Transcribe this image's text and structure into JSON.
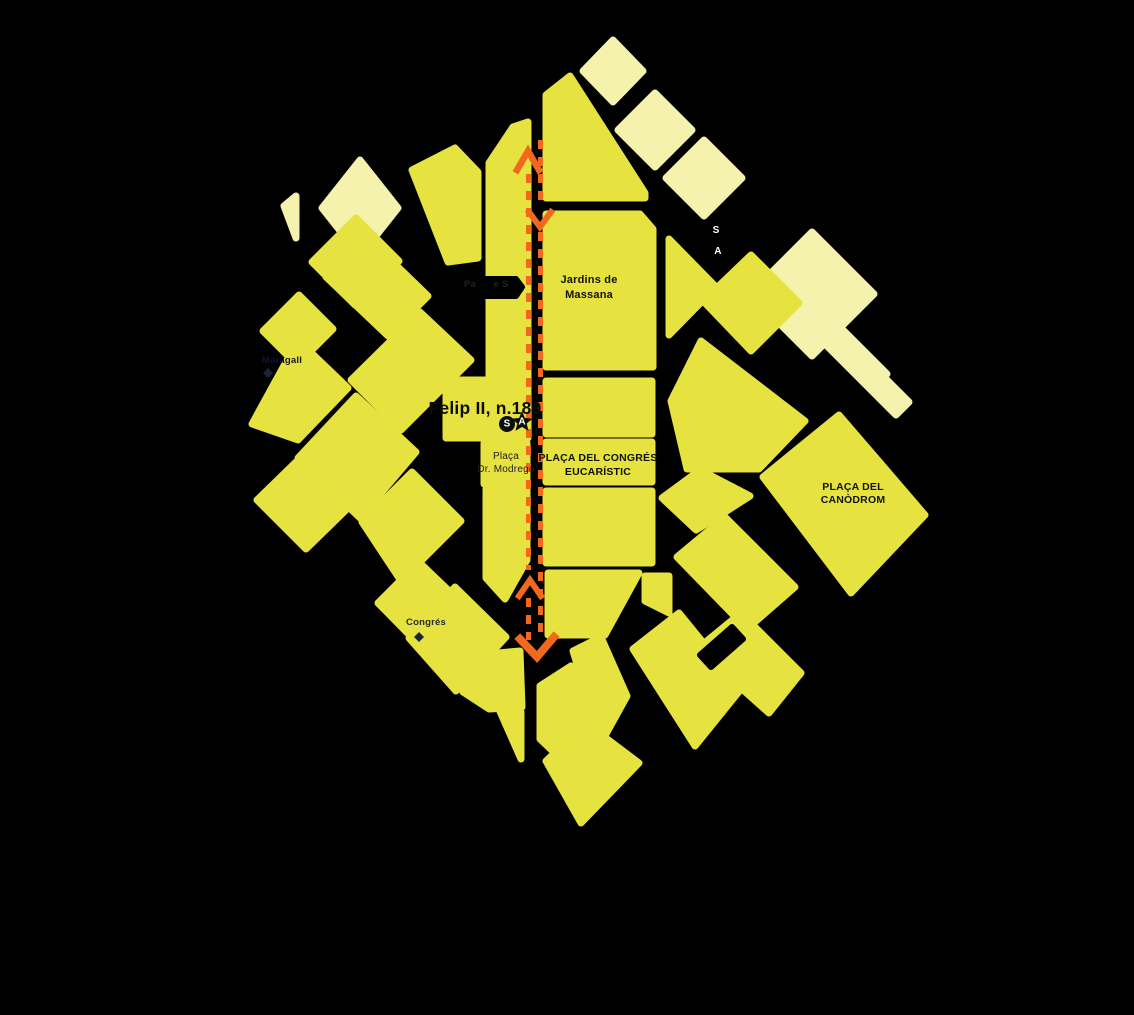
{
  "map": {
    "background_color": "#000000",
    "block_color": "#e6e23f",
    "pale_block_color": "#f5f2ae",
    "road_color": "#000000",
    "route_color": "#f2691e",
    "blocks": [
      {
        "name": "pale-diamond-1",
        "tone": "pale",
        "points": "613,40 643,71 613,102 583,71"
      },
      {
        "name": "pale-diamond-2",
        "tone": "pale",
        "points": "655,93 692,130 655,167 618,130"
      },
      {
        "name": "pale-diamond-3",
        "tone": "pale",
        "points": "704,140 742,178 704,216 666,178"
      },
      {
        "name": "pale-diamond-4",
        "tone": "pale",
        "points": "812,232 874,294 812,356 750,294"
      },
      {
        "name": "pale-stripe-1",
        "tone": "pale",
        "points": "799,312 812,299 887,374 874,387"
      },
      {
        "name": "pale-stripe-2",
        "tone": "pale",
        "points": "821,340 834,327 909,402 896,415"
      },
      {
        "name": "pale-diamond-5",
        "tone": "pale",
        "points": "360,160 398,208 360,256 322,208"
      },
      {
        "name": "pale-sliver",
        "tone": "pale",
        "points": "284,206 296,196 296,238"
      },
      {
        "name": "felip-strip",
        "tone": "main",
        "points": "489,163 513,127 528,122 528,438 446,438 446,380 489,380"
      },
      {
        "name": "top-block",
        "tone": "main",
        "points": "546,95 570,76 645,193 645,198 546,198"
      },
      {
        "name": "jardins-massana-block",
        "tone": "main",
        "points": "546,214 640,214 653,229 653,367 546,367"
      },
      {
        "name": "congres-upper-block",
        "tone": "main",
        "points": "546,381 652,381 652,434 546,434"
      },
      {
        "name": "congres-label-block",
        "tone": "main",
        "points": "546,442 652,442 652,482 546,482"
      },
      {
        "name": "congres-lower-block",
        "tone": "main",
        "points": "546,491 652,491 652,563 546,563"
      },
      {
        "name": "block-se-1",
        "tone": "main",
        "points": "548,573 639,573 605,635 548,635"
      },
      {
        "name": "block-se-2",
        "tone": "main",
        "points": "645,576 669,576 669,613 645,601"
      },
      {
        "name": "modrego-south-strip",
        "tone": "main",
        "points": "486,489 527,489 527,560 505,599 486,578"
      },
      {
        "name": "placa-modrego-block",
        "tone": "main",
        "points": "484,443 527,443 527,484 484,484"
      },
      {
        "name": "fan-strip-1",
        "tone": "main",
        "points": "412,170 455,148 478,172 478,258 448,262"
      },
      {
        "name": "fan-diamond-1",
        "tone": "main",
        "points": "312,262 356,218 399,261 355,305"
      },
      {
        "name": "fan-parallelogram-1",
        "tone": "main",
        "points": "366,236 428,296 388,336 326,277"
      },
      {
        "name": "fan-diamond-2",
        "tone": "main",
        "points": "263,331 299,295 333,329 297,365"
      },
      {
        "name": "west-wedge",
        "tone": "main",
        "points": "252,424 298,340 348,388 298,440"
      },
      {
        "name": "fan-big-diamond",
        "tone": "main",
        "points": "356,396 416,452 360,518 298,458"
      },
      {
        "name": "fan-parallelogram-2",
        "tone": "main",
        "points": "420,312 471,360 401,430 351,380"
      },
      {
        "name": "fan-diamond-3",
        "tone": "main",
        "points": "296,462 346,510 306,549 257,500"
      },
      {
        "name": "fan-diamond-4",
        "tone": "main",
        "points": "362,522 412,472 461,521 401,581"
      },
      {
        "name": "fan-diamond-5",
        "tone": "main",
        "points": "419,562 470,611 429,655 378,603"
      },
      {
        "name": "congres-station-diamond",
        "tone": "main",
        "points": "455,587 506,637 456,691 409,638"
      },
      {
        "name": "bottom-left-block",
        "tone": "main",
        "points": "463,656 520,651 522,707 489,709 463,692"
      },
      {
        "name": "bottom-left-triangle",
        "tone": "main",
        "points": "498,707 521,712 521,759"
      },
      {
        "name": "bottom-block-1",
        "tone": "main",
        "points": "540,686 571,666 593,689 593,741 563,761 540,739"
      },
      {
        "name": "bottom-block-2",
        "tone": "main",
        "points": "573,651 601,637 627,696 601,743"
      },
      {
        "name": "bottom-tip-diamond",
        "tone": "main",
        "points": "546,761 586,723 639,763 581,823"
      },
      {
        "name": "bottom-band-1",
        "tone": "main",
        "points": "633,649 679,613 741,689 695,746"
      },
      {
        "name": "bottom-band-2",
        "tone": "main",
        "points": "697,649 741,613 801,673 769,713"
      },
      {
        "name": "lower-right-diamond",
        "tone": "main",
        "points": "677,557 725,517 795,587 747,629"
      },
      {
        "name": "east-triangle",
        "tone": "main",
        "points": "669,239 716,287 669,335"
      },
      {
        "name": "east-diamond-1",
        "tone": "main",
        "points": "703,301 751,255 799,303 751,351"
      },
      {
        "name": "east-band",
        "tone": "main",
        "points": "671,401 701,341 805,421 759,469 687,469"
      },
      {
        "name": "canodrom-diamond",
        "tone": "main",
        "points": "839,415 925,515 851,593 763,477"
      },
      {
        "name": "east-small-block",
        "tone": "main",
        "points": "662,498 700,470 750,496 722,514 696,530"
      }
    ],
    "road_overlays": [
      {
        "name": "dead-end-street-stub",
        "points": "440,279 516,279 522,287 516,296 440,296"
      },
      {
        "name": "diagonal-street-notch",
        "points": "700,655 732,627 743,639 711,667"
      }
    ],
    "route": {
      "dash": "9 8",
      "line_width": 5,
      "lines": [
        {
          "name": "route-line-north",
          "x": 528.5,
          "segments": [
            [
              174,
              570
            ],
            [
              598,
              640
            ]
          ]
        },
        {
          "name": "route-line-south",
          "x": 540.5,
          "segments": [
            [
              140,
              206
            ],
            [
              232,
              634
            ]
          ]
        }
      ],
      "chevrons": [
        {
          "name": "route-arrow-up-top",
          "points": "517,170 528,151 539,170",
          "width": 6.5
        },
        {
          "name": "route-arrow-down-mid",
          "points": "529,212 540,227 551,212",
          "width": 6
        },
        {
          "name": "route-arrow-up-mid",
          "points": "519,596 530,580 541,596",
          "width": 6
        },
        {
          "name": "route-arrow-down-bottom",
          "points": "520,639 537,657 554,637",
          "width": 8
        }
      ]
    },
    "labels": [
      {
        "name": "label-felip-ii",
        "lines": [
          "Felip II, n.189"
        ],
        "x": 485,
        "y": 414,
        "size": 17.5,
        "weight": 700,
        "fill": "#0d0d0d",
        "lh": 18
      },
      {
        "name": "label-jardins-massana",
        "lines": [
          "Jardins de",
          "Massana"
        ],
        "x": 589,
        "y": 283,
        "size": 11,
        "weight": 700,
        "fill": "#111111",
        "lh": 15
      },
      {
        "name": "label-placa-congres",
        "lines": [
          "PLAÇA DEL CONGRÉS",
          "EUCARÍSTIC"
        ],
        "x": 598,
        "y": 461,
        "size": 10.5,
        "weight": 700,
        "fill": "#111111",
        "lh": 14
      },
      {
        "name": "label-placa-canodrom",
        "lines": [
          "PLAÇA DEL",
          "CANÒDROM"
        ],
        "x": 853,
        "y": 490,
        "size": 10.5,
        "weight": 700,
        "fill": "#111111",
        "lh": 13
      },
      {
        "name": "label-placa-modrego",
        "lines": [
          "Plaça",
          "Dr. Modrego"
        ],
        "x": 506,
        "y": 459,
        "size": 10,
        "weight": 400,
        "fill": "#222222",
        "lh": 13
      },
      {
        "name": "label-maragall",
        "lines": [
          "Maragall"
        ],
        "x": 282,
        "y": 363,
        "size": 9.5,
        "weight": 700,
        "fill": "#10152b",
        "lh": 10
      },
      {
        "name": "label-congres-station",
        "lines": [
          "Congrés"
        ],
        "x": 426,
        "y": 625,
        "size": 9.5,
        "weight": 600,
        "fill": "#2a2a2a",
        "lh": 10
      },
      {
        "name": "label-street-letter-s",
        "lines": [
          "S"
        ],
        "x": 716,
        "y": 233,
        "size": 10,
        "weight": 700,
        "fill": "#ffffff",
        "lh": 10
      },
      {
        "name": "label-street-letter-a",
        "lines": [
          "A"
        ],
        "x": 718,
        "y": 254,
        "size": 10,
        "weight": 700,
        "fill": "#ffffff",
        "lh": 10
      },
      {
        "name": "label-street-fragment-pa",
        "lines": [
          "Pa"
        ],
        "x": 470,
        "y": 287,
        "size": 9.5,
        "weight": 600,
        "fill": "#222222",
        "lh": 10
      },
      {
        "name": "label-street-fragment-es",
        "lines": [
          "e S"
        ],
        "x": 501,
        "y": 287,
        "size": 9.5,
        "weight": 600,
        "fill": "#222222",
        "lh": 10
      }
    ],
    "markers": [
      {
        "name": "start-marker-s",
        "type": "circle",
        "x": 507,
        "y": 424,
        "r": 8,
        "fill": "#0d0d0d",
        "letter": "S",
        "letter_fill": "#ffffff",
        "letter_size": 10
      },
      {
        "name": "arrival-marker-a",
        "type": "star",
        "x": 522,
        "y": 422,
        "r": 11,
        "fill": "#0d0d0d",
        "letter": "A",
        "letter_fill": "#ffffff",
        "letter_size": 10
      },
      {
        "name": "maragall-metro-icon",
        "type": "diamond",
        "x": 268,
        "y": 373,
        "r": 5,
        "fill": "#1d2433"
      },
      {
        "name": "congres-metro-icon",
        "type": "diamond",
        "x": 419,
        "y": 637,
        "r": 5,
        "fill": "#1d2433"
      }
    ]
  }
}
